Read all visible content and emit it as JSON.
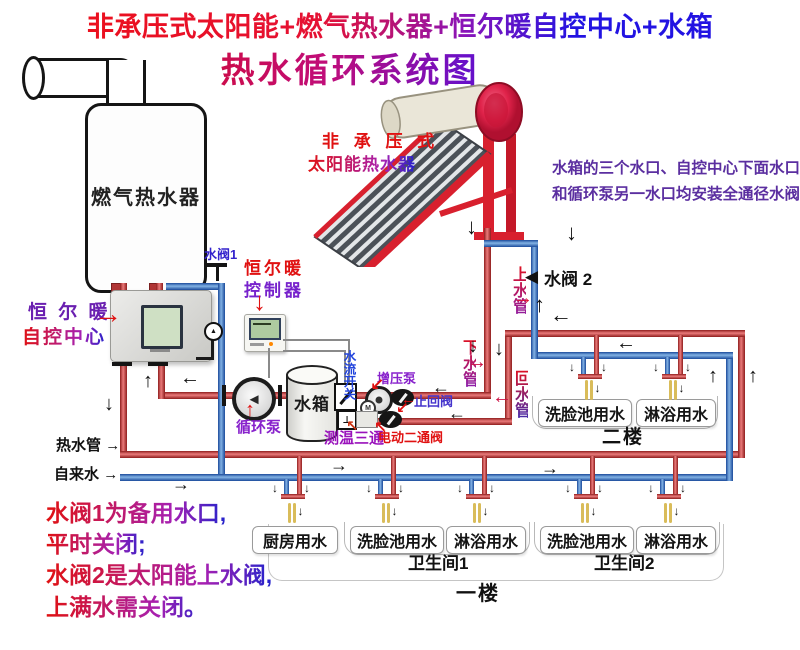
{
  "title": {
    "line1": "非承压式太阳能+燃气热水器+恒尔暖自控中心+水箱",
    "line2": "热水循环系统图"
  },
  "solar": {
    "label_line1": "非 承 压 式",
    "label_line2": "太阳能热水器"
  },
  "gas_heater": {
    "label": "燃气热水器"
  },
  "control_center": {
    "label_line1": "恒 尔 暖",
    "label_line2": "自控中心"
  },
  "controller": {
    "label_line1": "恒尔暖",
    "label_line2": "控制器"
  },
  "tank": {
    "label": "水箱"
  },
  "pumps": {
    "circulation": "循环泵",
    "booster": "增压泵"
  },
  "valves": {
    "valve1": "水阀1",
    "valve2": "水阀 2",
    "check": "止回阀",
    "electric": "电动二通阀",
    "temp_tee": "测温三通",
    "flow_switch": "水流开关"
  },
  "pipes": {
    "hot": "热水管",
    "tap": "自来水",
    "supply": "上水管",
    "down": "下水管",
    "return": "回水管"
  },
  "floor2": {
    "label": "二楼",
    "fixtures": [
      "洗脸池用水",
      "淋浴用水"
    ]
  },
  "floor1": {
    "label": "一楼",
    "bathroom1": "卫生间1",
    "bathroom2": "卫生间2",
    "fixtures": [
      "厨房用水",
      "洗脸池用水",
      "淋浴用水",
      "洗脸池用水",
      "淋浴用水"
    ]
  },
  "notes": {
    "top_right_line1": "水箱的三个水口、自控中心下面水口",
    "top_right_line2": "和循环泵另一水口均安装全通径水阀",
    "bottom_left": [
      "水阀1为备用水口,",
      "平时关闭;",
      "水阀2是太阳能上水阀,",
      "上满水需关闭。"
    ]
  },
  "icons": {
    "arrow_right": "→",
    "arrow_left": "←",
    "arrow_up": "↑",
    "arrow_down": "↓",
    "arrow_up_left": "↖",
    "arrow_down_left": "↙",
    "triangle_left": "◀",
    "tee": "⊥",
    "motor": "M",
    "pump_triangle": "◄"
  },
  "colors": {
    "hot_pipe": "#c22525",
    "cold_pipe": "#2458b8",
    "accent_red": "#e01111",
    "accent_purple": "#7a22cc",
    "accent_blue": "#2233cc",
    "note_purple": "#5b2fa0",
    "faucet": "#d9bc5a"
  }
}
